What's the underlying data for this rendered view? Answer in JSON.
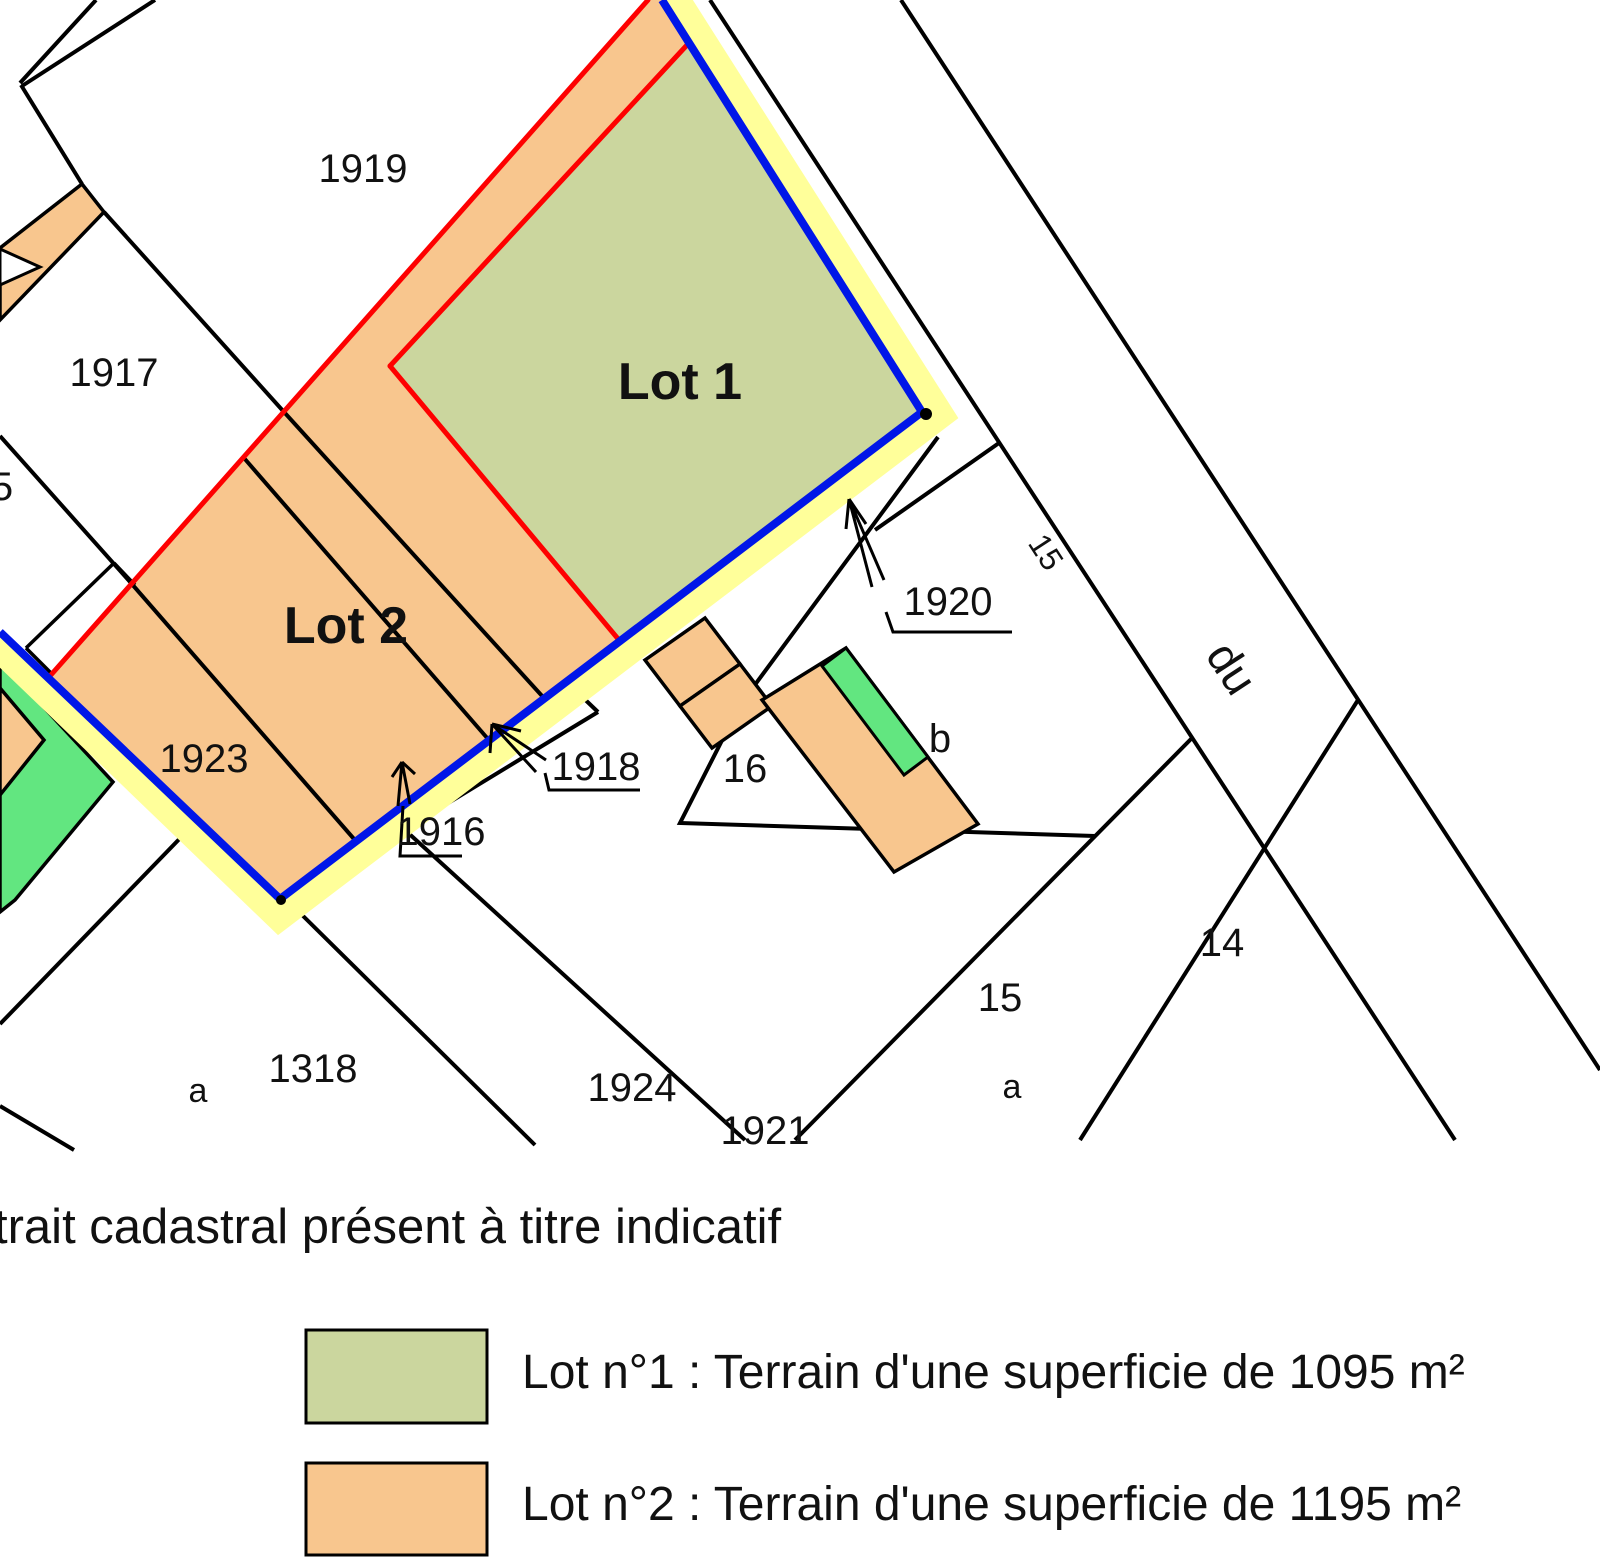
{
  "palette": {
    "lot1_fill": "#CBD69E",
    "lot2_fill": "#F8C68E",
    "highlight_yellow": "#FFFF9A",
    "boundary_blue": "#0016E8",
    "boundary_red": "#FE0000",
    "vegetation_green": "#62E680",
    "line_black": "#000000"
  },
  "map": {
    "labels": [
      {
        "text": "1919"
      },
      {
        "text": "1917"
      },
      {
        "text": "5"
      },
      {
        "text": "1923"
      },
      {
        "text": "Lot 2"
      },
      {
        "text": "Lot 1"
      },
      {
        "text": "1920"
      },
      {
        "text": "1918"
      },
      {
        "text": "1916"
      },
      {
        "text": "16"
      },
      {
        "text": "b"
      },
      {
        "text": "15"
      },
      {
        "text": "du"
      },
      {
        "text": "15"
      },
      {
        "text": "a"
      },
      {
        "text": "14"
      },
      {
        "text": "1921"
      },
      {
        "text": "1924"
      },
      {
        "text": "1318"
      },
      {
        "text": "a"
      }
    ]
  },
  "caption": "trait cadastral présent à titre indicatif",
  "legend": {
    "items": [
      {
        "label": "Lot n°1 : Terrain d'une superficie de 1095 m²",
        "color": "#CBD69E"
      },
      {
        "label": "Lot n°2 : Terrain d'une superficie de 1195 m²",
        "color": "#F8C68E"
      }
    ]
  }
}
